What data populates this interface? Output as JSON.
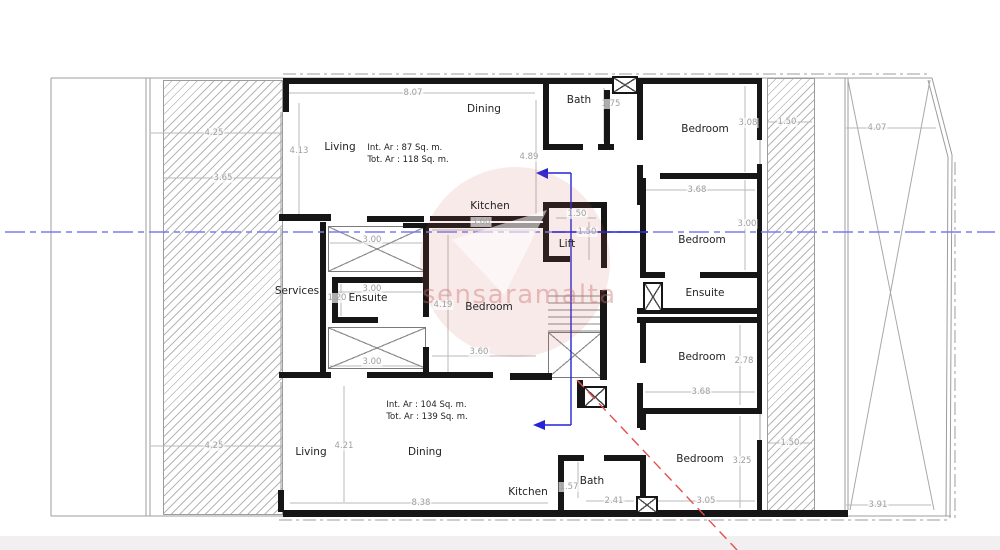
{
  "watermark": {
    "text": "sensaramalta"
  },
  "colors": {
    "wall": "#161616",
    "thin_line": "#9c9c9c",
    "dimension_text": "#9e9e9e",
    "centerline_blue": "#7b7bee",
    "section_blue": "#2424d6",
    "red_dashed": "#e35050",
    "watermark_pink": "#cd5c5c"
  },
  "room_labels": [
    {
      "text": "Living",
      "x": 340,
      "y": 147
    },
    {
      "text": "Dining",
      "x": 484,
      "y": 109
    },
    {
      "text": "Kitchen",
      "x": 490,
      "y": 206
    },
    {
      "text": "Bath",
      "x": 579,
      "y": 100
    },
    {
      "text": "Bedroom",
      "x": 705,
      "y": 129
    },
    {
      "text": "Bedroom",
      "x": 702,
      "y": 240
    },
    {
      "text": "Ensuite",
      "x": 705,
      "y": 293
    },
    {
      "text": "Bedroom",
      "x": 702,
      "y": 357
    },
    {
      "text": "Bedroom",
      "x": 700,
      "y": 459
    },
    {
      "text": "Services",
      "x": 297,
      "y": 291
    },
    {
      "text": "Ensuite",
      "x": 368,
      "y": 298
    },
    {
      "text": "Bedroom",
      "x": 489,
      "y": 307
    },
    {
      "text": "Lift",
      "x": 567,
      "y": 244
    },
    {
      "text": "Living",
      "x": 311,
      "y": 452
    },
    {
      "text": "Dining",
      "x": 425,
      "y": 452
    },
    {
      "text": "Kitchen",
      "x": 528,
      "y": 492
    },
    {
      "text": "Bath",
      "x": 592,
      "y": 481
    }
  ],
  "dim_labels": [
    {
      "text": "8.07",
      "x": 413,
      "y": 93
    },
    {
      "text": "4.13",
      "x": 299,
      "y": 151
    },
    {
      "text": "4.89",
      "x": 529,
      "y": 157
    },
    {
      "text": "4.25",
      "x": 214,
      "y": 133
    },
    {
      "text": "3.65",
      "x": 223,
      "y": 178
    },
    {
      "text": "4.25",
      "x": 214,
      "y": 446
    },
    {
      "text": "1.75",
      "x": 611,
      "y": 104
    },
    {
      "text": "3.08",
      "x": 748,
      "y": 123
    },
    {
      "text": "1.50",
      "x": 787,
      "y": 122
    },
    {
      "text": "4.07",
      "x": 877,
      "y": 128
    },
    {
      "text": "3.68",
      "x": 697,
      "y": 190
    },
    {
      "text": "3.00",
      "x": 747,
      "y": 224
    },
    {
      "text": "3.00",
      "x": 372,
      "y": 240
    },
    {
      "text": "3.00",
      "x": 372,
      "y": 289
    },
    {
      "text": "1.20",
      "x": 337,
      "y": 298
    },
    {
      "text": "3.00",
      "x": 372,
      "y": 362
    },
    {
      "text": "3.60",
      "x": 481,
      "y": 222
    },
    {
      "text": "3.60",
      "x": 479,
      "y": 352
    },
    {
      "text": "4.19",
      "x": 443,
      "y": 305
    },
    {
      "text": "1.50",
      "x": 577,
      "y": 214
    },
    {
      "text": "1.50",
      "x": 587,
      "y": 232
    },
    {
      "text": "2.78",
      "x": 744,
      "y": 361
    },
    {
      "text": "3.68",
      "x": 701,
      "y": 392
    },
    {
      "text": "1.50",
      "x": 790,
      "y": 443
    },
    {
      "text": "3.25",
      "x": 742,
      "y": 461
    },
    {
      "text": "3.05",
      "x": 706,
      "y": 501
    },
    {
      "text": "3.91",
      "x": 878,
      "y": 505
    },
    {
      "text": "4.21",
      "x": 344,
      "y": 446
    },
    {
      "text": "8.38",
      "x": 421,
      "y": 503
    },
    {
      "text": "1.57",
      "x": 569,
      "y": 487
    },
    {
      "text": "2.41",
      "x": 614,
      "y": 501
    }
  ],
  "area_labels": [
    {
      "line1": "Int. Ar : 87 Sq. m.",
      "line2": "Tot. Ar : 118 Sq. m.",
      "x": 408,
      "y": 155
    },
    {
      "line1": "Int. Ar : 104 Sq. m.",
      "line2": "Tot. Ar : 139 Sq. m.",
      "x": 427,
      "y": 412
    }
  ]
}
